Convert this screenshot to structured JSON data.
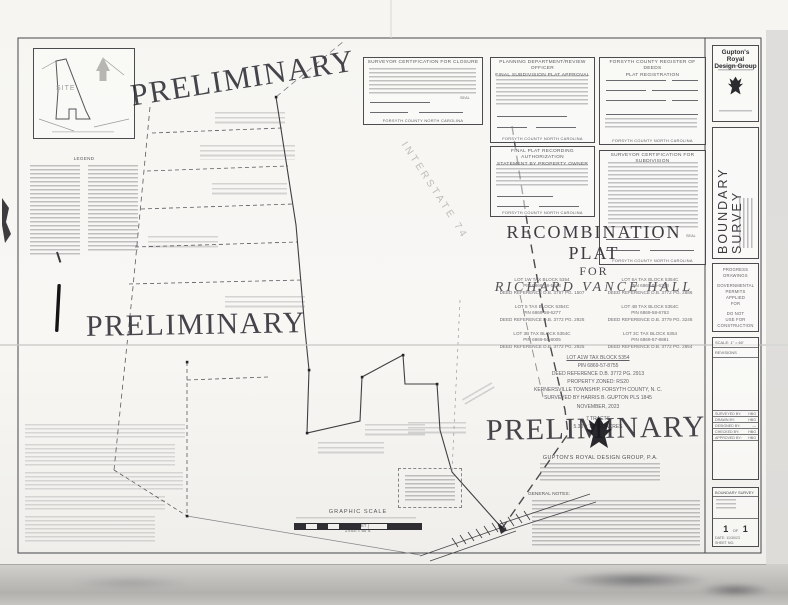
{
  "colors": {
    "ink": "#3a3a3e",
    "paper": "#f6f5f2",
    "watermark": "#2c2c33"
  },
  "watermark": {
    "text": "PRELIMINARY"
  },
  "vicinity": {
    "site_label": "SITE"
  },
  "legend": {
    "title": "LEGEND"
  },
  "certs": {
    "seal_label": "SEAL",
    "closure": {
      "title": "SURVEYOR CERTIFICATION FOR CLOSURE",
      "county": "FORSYTH COUNTY NORTH CAROLINA"
    },
    "planning": {
      "title1": "PLANNING DEPARTMENT/REVIEW OFFICER",
      "title2": "FINAL SUBDIVISION PLAT APPROVAL",
      "county": "FORSYTH COUNTY NORTH CAROLINA"
    },
    "deeds": {
      "title1": "FORSYTH COUNTY REGISTER OF DEEDS",
      "title2": "PLAT REGISTRATION",
      "county": "FORSYTH COUNTY NORTH CAROLINA"
    },
    "recording": {
      "title1": "FINAL PLAT RECORDING AUTHORIZATION",
      "title2": "STATEMENT BY PROPERTY OWNER",
      "county": "FORSYTH COUNTY NORTH CAROLINA"
    },
    "subdivision": {
      "title": "SURVEYOR CERTIFICATION FOR SUBDIVISION",
      "county": "FORSYTH COUNTY NORTH CAROLINA"
    }
  },
  "title_block": {
    "title": "RECOMBINATION PLAT",
    "for_label": "FOR",
    "client": "RICHARD VANCE HALL",
    "lots": [
      {
        "l1": "LOT 1W TAX BLOCK 5354",
        "l2": "PIN 6869-58-5248",
        "l3": "DEED REFERENCE D.B. 3787 PG. 1507"
      },
      {
        "l1": "LOT 6A TAX BLOCK 5354C",
        "l2": "PIN 6869-58-6348",
        "l3": "DEED REFERENCE D.B. 3772 PG. 2886"
      },
      {
        "l1": "LOT 5 TAX BLOCK 5354C",
        "l2": "PIN 6869-58-6277",
        "l3": "DEED REFERENCE D.B. 3772 PG. 2925"
      },
      {
        "l1": "LOT 4B TAX BLOCK 5354C",
        "l2": "PIN 6869-58-6763",
        "l3": "DEED REFERENCE D.B. 3779 PG. 3246"
      },
      {
        "l1": "LOT 3B TAX BLOCK 5354C",
        "l2": "PIN 6869-56-8005",
        "l3": "DEED REFERENCE D.B. 3772 PG. 2925"
      },
      {
        "l1": "LOT 3C TAX BLOCK 5354",
        "l2": "PIN 6869-57-8881",
        "l3": "DEED REFERENCE D.B. 3772 PG. 2854"
      }
    ],
    "summary": [
      "LOT A1W TAX BLOCK 5354",
      "PIN 6869-57-8755",
      "DEED REFERENCE D.B. 3772 PG. 2913",
      "PROPERTY ZONED: RS20",
      "KERNERSVILLE TOWNSHIP, FORSYTH COUNTY, N. C.",
      "SURVEYED BY HARRIS B. GUPTON PLS 1845",
      "NOVEMBER, 2023",
      "7 TRACTS",
      "5.30 ± TOTAL ACRES"
    ]
  },
  "drawing": {
    "interstate_label": "INTERSTATE 74"
  },
  "scale_bar": {
    "title": "GRAPHIC SCALE",
    "in_feet": "( IN FEET )",
    "ratio": "1 inch = 60 ft."
  },
  "company": {
    "name": "GUPTON'S ROYAL DESIGN GROUP, P.A."
  },
  "notes": {
    "title": "GENERAL NOTES:"
  },
  "sidebar": {
    "logo_name_1": "Gupton's Royal",
    "logo_name_2": "Design Group",
    "vertical_title": "BOUNDARY SURVEY",
    "progress_lines": [
      "PROGRESS",
      "DRAWINGS"
    ],
    "permit_lines": [
      "GOVERNMENTAL",
      "PERMITS",
      "APPLIED",
      "FOR"
    ],
    "construction_lines": [
      "DO NOT",
      "USE FOR",
      "CONSTRUCTION"
    ],
    "scale_label": "SCALE: 1\" = 60'",
    "revisions_label": "REVISIONS",
    "crew": [
      {
        "label": "SURVEYED BY:",
        "value": "HBG"
      },
      {
        "label": "DRAWN BY:",
        "value": "HBG"
      },
      {
        "label": "DESIGNED BY:",
        "value": "—"
      },
      {
        "label": "CHECKED BY:",
        "value": "HBG"
      },
      {
        "label": "APPROVED BY:",
        "value": "HBG"
      }
    ],
    "title_box": {
      "header": "BOUNDARY SURVEY",
      "sheet_left": "1",
      "of_label": "OF",
      "sheet_right": "1",
      "date": "DATE: 11/30/23",
      "sheet_no": "SHEET NO."
    }
  }
}
